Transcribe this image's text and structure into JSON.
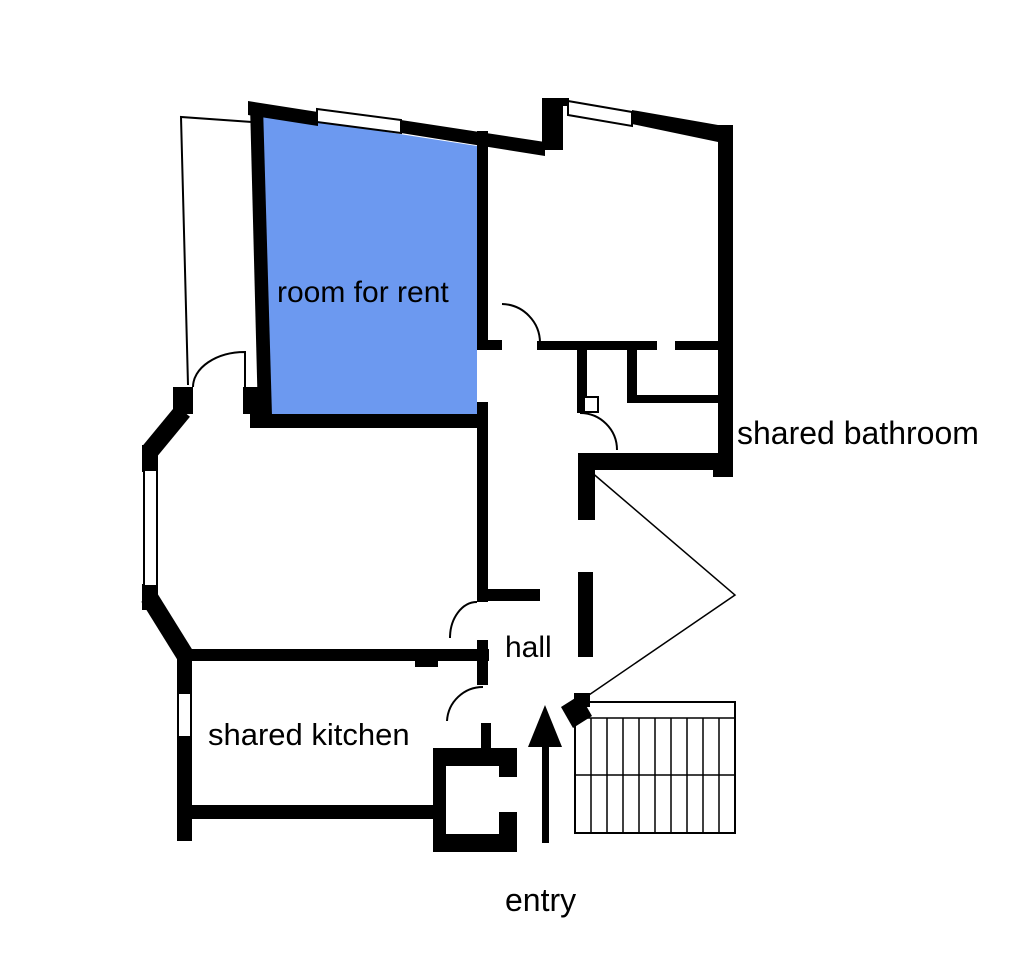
{
  "floor_plan": {
    "labels": {
      "room_for_rent": "room for rent",
      "shared_bathroom": "shared bathroom",
      "hall": "hall",
      "shared_kitchen": "shared kitchen",
      "entry": "entry"
    },
    "colors": {
      "wall": "#000000",
      "room_for_rent_fill": "#6c99f0",
      "background": "#ffffff"
    },
    "icons": {
      "entry_arrow": "up-arrow"
    }
  }
}
